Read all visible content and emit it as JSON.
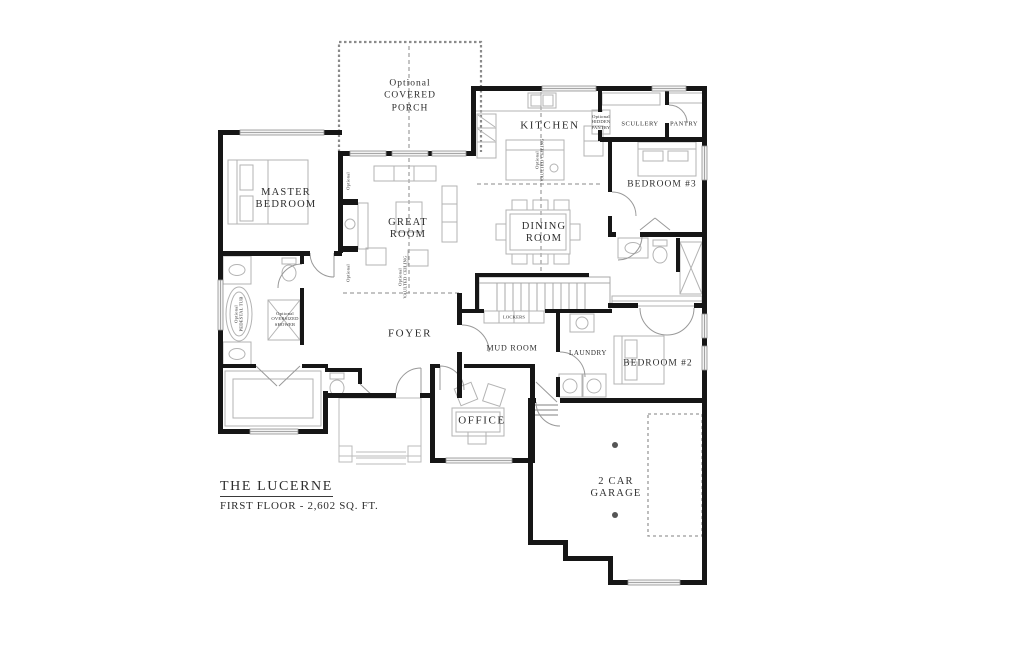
{
  "title_block": {
    "plan_name": "THE LUCERNE",
    "floor_label": "FIRST FLOOR - 2,602 SQ. FT."
  },
  "rooms": {
    "covered_porch": {
      "line1": "Optional",
      "line2": "COVERED",
      "line3": "PORCH"
    },
    "kitchen": {
      "label": "KITCHEN"
    },
    "scullery": {
      "label": "SCULLERY"
    },
    "pantry": {
      "label": "PANTRY"
    },
    "master_bedroom": {
      "line1": "MASTER",
      "line2": "BEDROOM"
    },
    "great_room": {
      "line1": "GREAT",
      "line2": "ROOM"
    },
    "dining_room": {
      "line1": "DINING",
      "line2": "ROOM"
    },
    "bedroom_3": {
      "label": "BEDROOM #3"
    },
    "bedroom_2": {
      "label": "BEDROOM #2"
    },
    "foyer": {
      "label": "FOYER"
    },
    "mud_room": {
      "label": "MUD ROOM"
    },
    "laundry": {
      "label": "LAUNDRY"
    },
    "office": {
      "label": "OFFICE"
    },
    "garage": {
      "line1": "2 CAR",
      "line2": "GARAGE"
    }
  },
  "annotations": {
    "lockers": "LOCKERS",
    "hidden_pantry": {
      "line1": "Optional",
      "line2": "HIDDEN",
      "line3": "PANTRY"
    },
    "pedestal_tub": {
      "line1": "Optional",
      "line2": "PEDESTAL TUB"
    },
    "oversized_shower": {
      "line1": "Optional",
      "line2": "OVERSIZED",
      "line3": "SHOWER"
    },
    "great_room_ceiling": {
      "line1": "Optional",
      "line2": "VAULTED CEILING"
    },
    "kitchen_ceiling": {
      "line1": "Optional",
      "line2": "VAULTED CEILING"
    },
    "fireplace_upper": "Optional",
    "fireplace_lower": "Optional"
  },
  "colors": {
    "wall": "#161616",
    "fixture": "#b3b3b3",
    "dashed": "#8a8a8a",
    "text": "#2e2e2e",
    "background": "#ffffff"
  }
}
